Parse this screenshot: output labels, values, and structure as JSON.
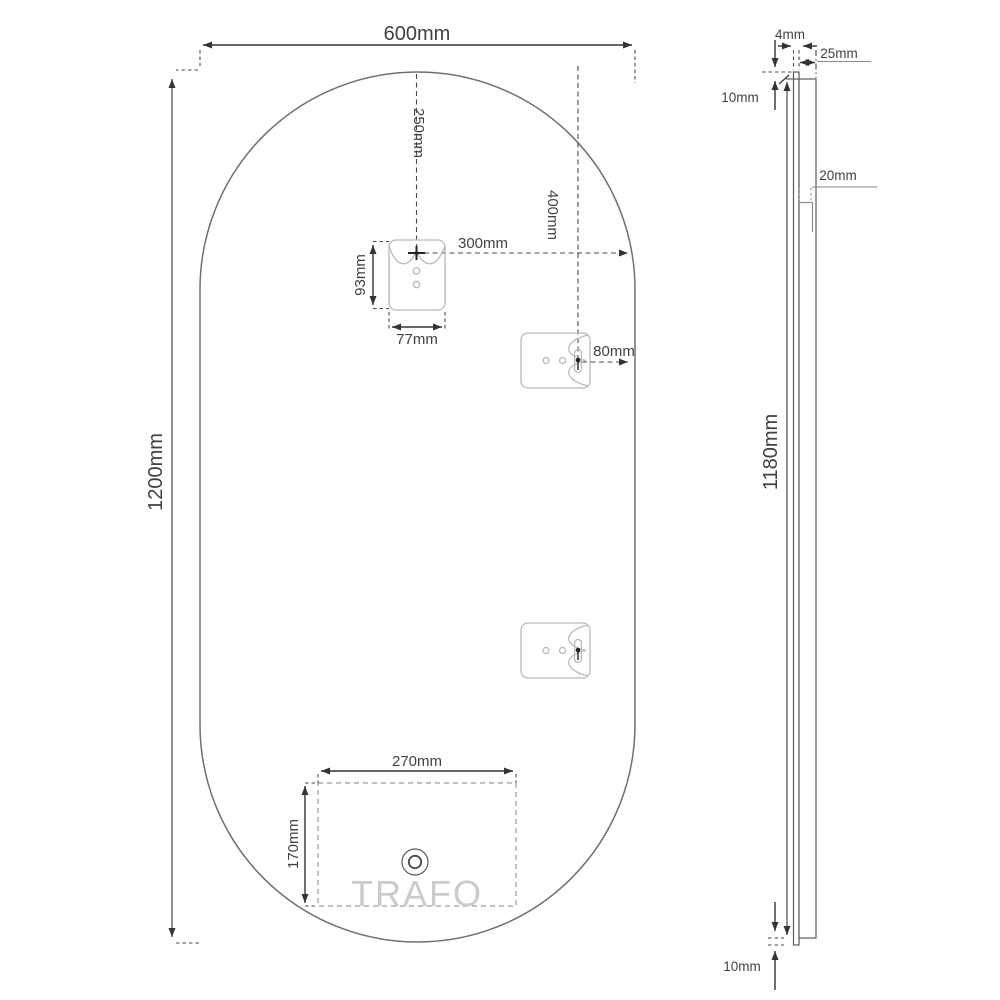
{
  "drawing": {
    "front": {
      "width": "600mm",
      "height": "1200mm",
      "bracket_top_offset": "250mm",
      "bracket_right_offset": "300mm",
      "bracket_height": "93mm",
      "bracket_width": "77mm",
      "side_bracket_top_offset": "400mm",
      "side_bracket_edge_offset": "80mm",
      "trafo_width": "270mm",
      "trafo_height": "170mm",
      "trafo_label": "TRAFO"
    },
    "side": {
      "glass_thickness": "4mm",
      "frame_depth": "25mm",
      "top_inset": "10mm",
      "cleat_depth": "20mm",
      "frame_height": "1180mm",
      "bottom_inset": "10mm"
    },
    "colors": {
      "background": "#ffffff",
      "dimension_line": "#333333",
      "long_dimension_line": "#6e6e6e",
      "mirror_outline": "#707070",
      "bracket_outline": "#bababa",
      "dashed_line": "#4a4a4a",
      "watermark": "#cbcbcb"
    }
  }
}
